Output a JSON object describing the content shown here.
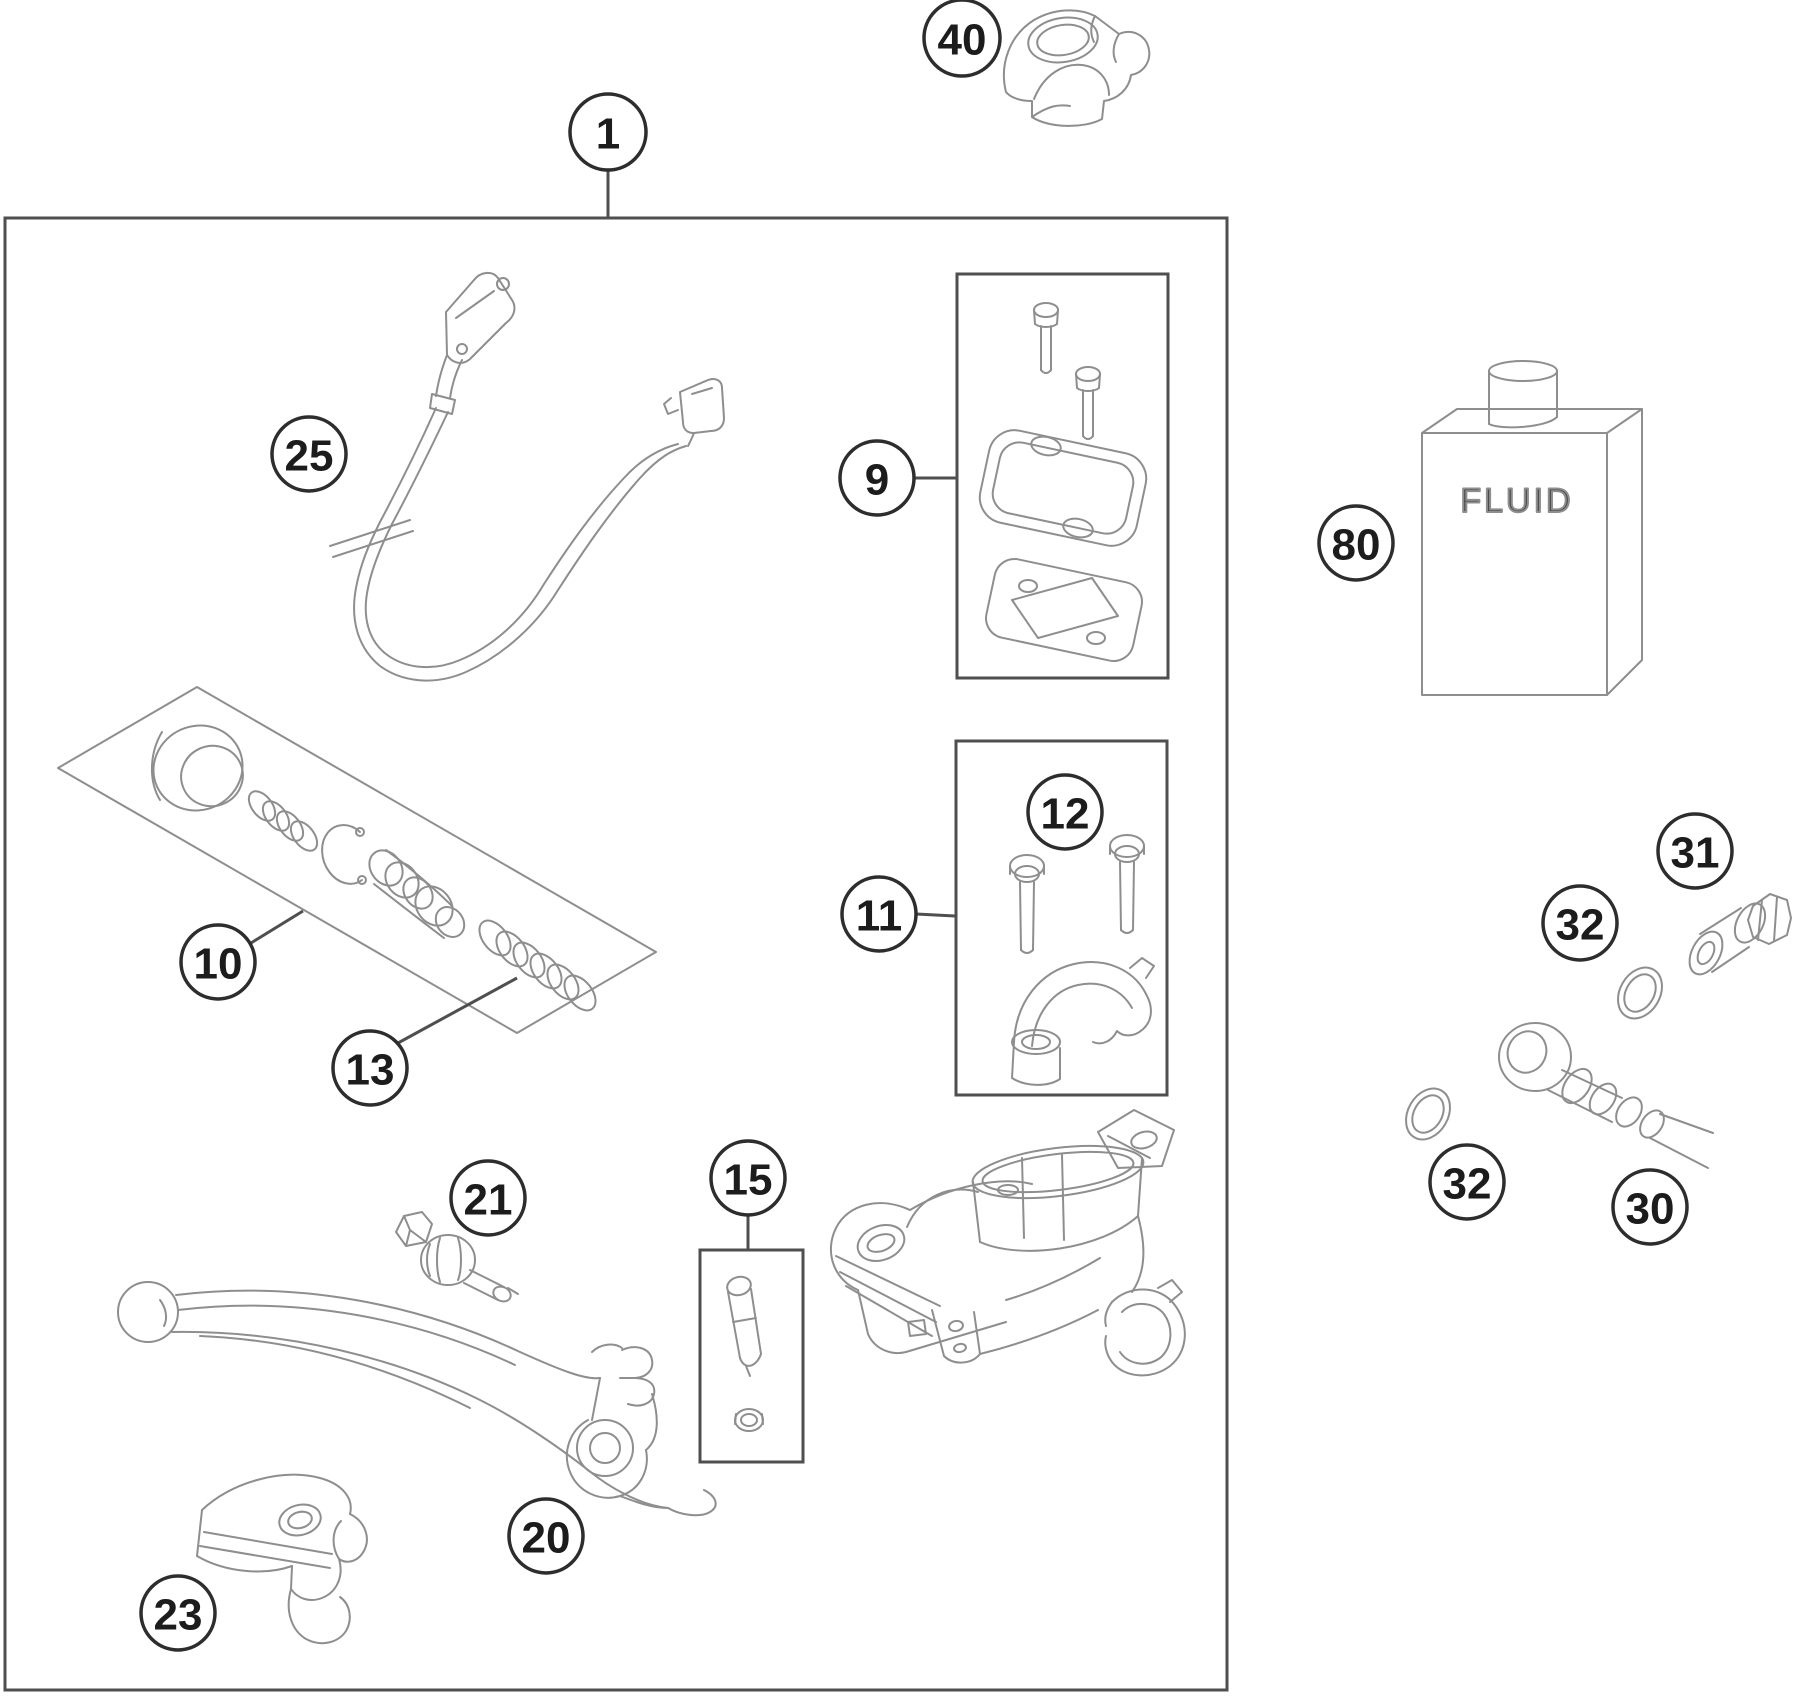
{
  "diagram": {
    "fluid_label": "FLUID",
    "colors": {
      "background": "#ffffff",
      "part_line": "#8e8e8e",
      "frame_line": "#4f4f4f",
      "callout_line": "#2d2d2d",
      "text": "#1c1c1c"
    },
    "callouts": [
      {
        "id": "1",
        "label": "1",
        "x": 608,
        "y": 132,
        "r": 38,
        "leader": [
          [
            608,
            171
          ],
          [
            608,
            218
          ]
        ]
      },
      {
        "id": "40",
        "label": "40",
        "x": 962,
        "y": 38,
        "r": 38
      },
      {
        "id": "25",
        "label": "25",
        "x": 309,
        "y": 454,
        "r": 37
      },
      {
        "id": "9",
        "label": "9",
        "x": 877,
        "y": 478,
        "r": 37,
        "leader": [
          [
            914,
            478
          ],
          [
            956,
            478
          ]
        ]
      },
      {
        "id": "80",
        "label": "80",
        "x": 1356,
        "y": 543,
        "r": 37
      },
      {
        "id": "10",
        "label": "10",
        "x": 218,
        "y": 962,
        "r": 37,
        "leader": [
          [
            251,
            943
          ],
          [
            303,
            911
          ]
        ]
      },
      {
        "id": "13",
        "label": "13",
        "x": 370,
        "y": 1068,
        "r": 37,
        "leader": [
          [
            398,
            1043
          ],
          [
            517,
            978
          ]
        ]
      },
      {
        "id": "11",
        "label": "11",
        "x": 879,
        "y": 914,
        "r": 37,
        "leader": [
          [
            916,
            914
          ],
          [
            955,
            916
          ]
        ]
      },
      {
        "id": "12",
        "label": "12",
        "x": 1065,
        "y": 812,
        "r": 37
      },
      {
        "id": "15",
        "label": "15",
        "x": 748,
        "y": 1178,
        "r": 37,
        "leader": [
          [
            748,
            1215
          ],
          [
            748,
            1250
          ]
        ]
      },
      {
        "id": "21",
        "label": "21",
        "x": 488,
        "y": 1198,
        "r": 37
      },
      {
        "id": "20",
        "label": "20",
        "x": 546,
        "y": 1536,
        "r": 37
      },
      {
        "id": "23",
        "label": "23",
        "x": 178,
        "y": 1613,
        "r": 37
      },
      {
        "id": "31",
        "label": "31",
        "x": 1695,
        "y": 851,
        "r": 37
      },
      {
        "id": "32a",
        "label": "32",
        "x": 1580,
        "y": 923,
        "r": 37
      },
      {
        "id": "32b",
        "label": "32",
        "x": 1467,
        "y": 1182,
        "r": 37
      },
      {
        "id": "30",
        "label": "30",
        "x": 1650,
        "y": 1207,
        "r": 37
      }
    ]
  }
}
